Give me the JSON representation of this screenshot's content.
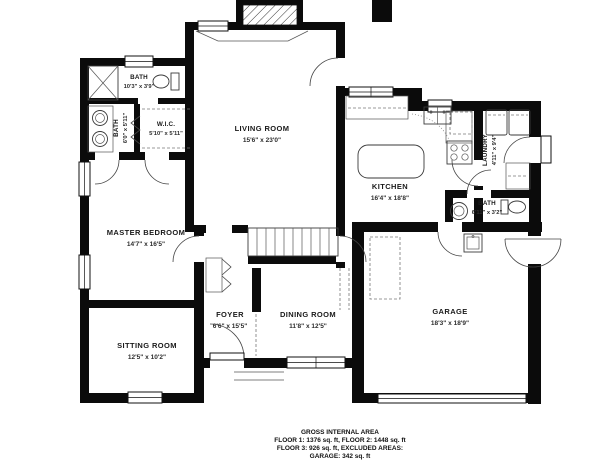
{
  "plan_title": "Floor plan",
  "rooms": [
    {
      "id": "bath-top",
      "name": "BATH",
      "dims": "10'3\" x 3'9\""
    },
    {
      "id": "bath-left",
      "name": "BATH",
      "dims": "6'0\" x 5'11\""
    },
    {
      "id": "wic",
      "name": "W.I.C.",
      "dims": "5'10\" x 5'11\""
    },
    {
      "id": "living-room",
      "name": "LIVING ROOM",
      "dims": "15'6\" x 23'0\""
    },
    {
      "id": "kitchen",
      "name": "KITCHEN",
      "dims": "16'4\" x 18'8\""
    },
    {
      "id": "laundry",
      "name": "LAUNDRY",
      "dims": "4'11\" x 9'4\""
    },
    {
      "id": "bath-right",
      "name": "BATH",
      "dims": "6'11\" x 3'2\""
    },
    {
      "id": "master-bedroom",
      "name": "MASTER BEDROOM",
      "dims": "14'7\" x 16'5\""
    },
    {
      "id": "sitting-room",
      "name": "SITTING ROOM",
      "dims": "12'5\" x 10'2\""
    },
    {
      "id": "foyer",
      "name": "FOYER",
      "dims": "6'6\" x 15'5\""
    },
    {
      "id": "dining-room",
      "name": "DINING ROOM",
      "dims": "11'8\" x 12'5\""
    },
    {
      "id": "garage",
      "name": "GARAGE",
      "dims": "18'3\" x 18'9\""
    }
  ],
  "caption": {
    "line1": "GROSS INTERNAL AREA",
    "line2": "FLOOR 1: 1376 sq. ft, FLOOR 2: 1448 sq. ft",
    "line3": "FLOOR 3: 926 sq. ft, EXCLUDED AREAS:",
    "line4": "GARAGE: 342 sq. ft"
  },
  "colors": {
    "wall": "#0b0b0b",
    "background": "#ffffff",
    "line": "#3a3a3a",
    "text": "#1a1a1a"
  }
}
